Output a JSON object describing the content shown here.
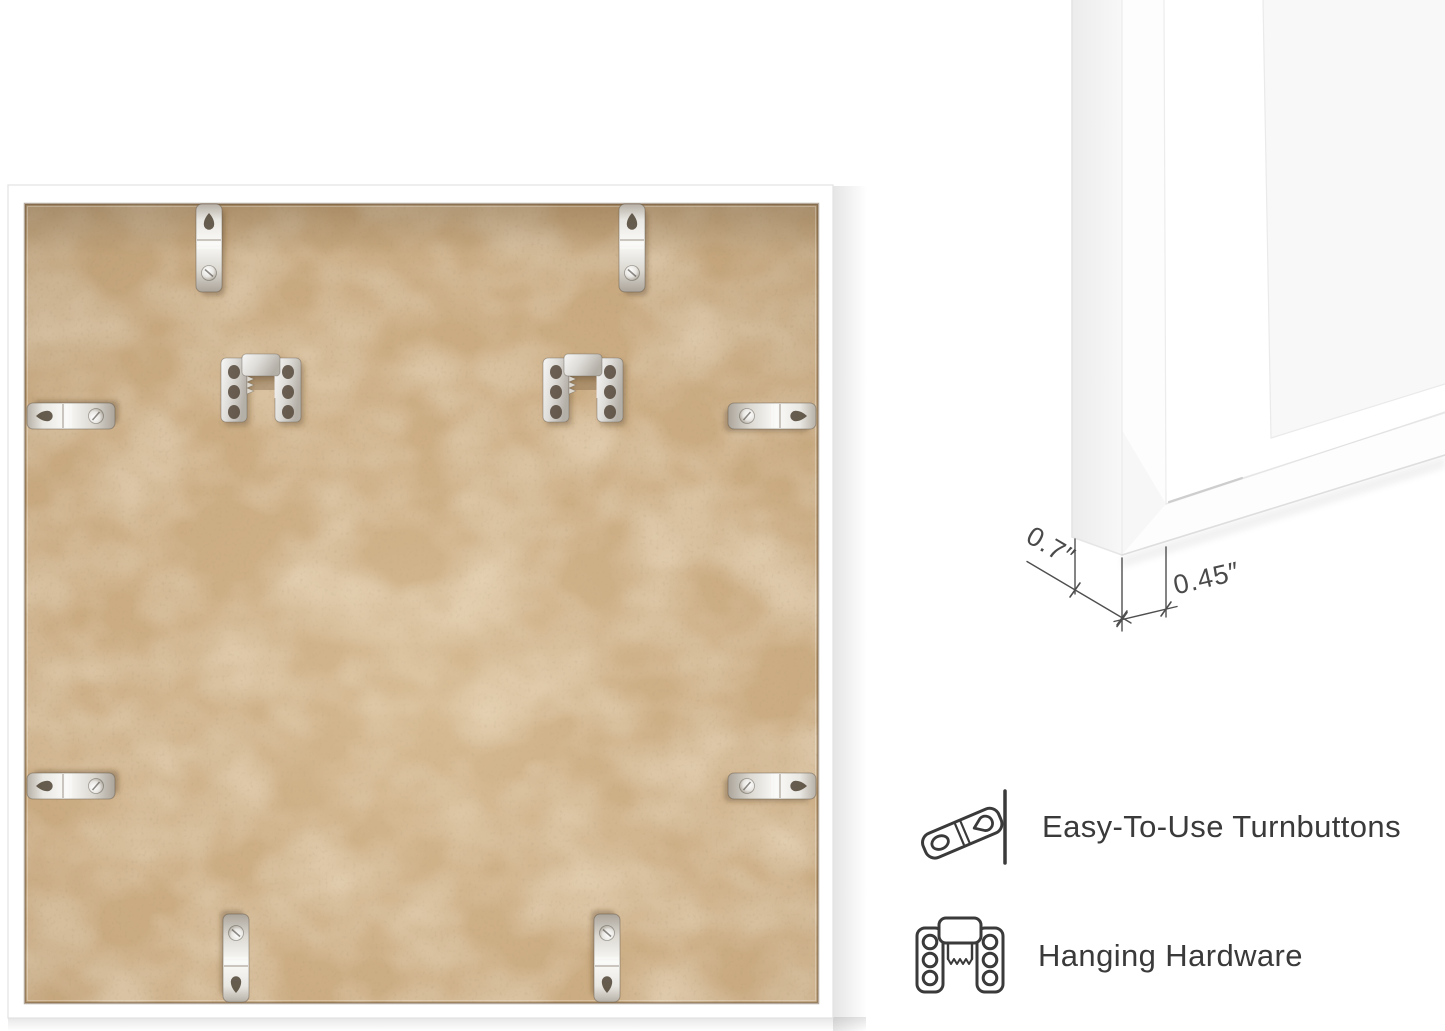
{
  "canvas": {
    "width": 1445,
    "height": 1031,
    "background": "#ffffff"
  },
  "dimension_callout": {
    "depth": "0.7″",
    "face_width": "0.45″"
  },
  "features": [
    {
      "icon": "turnbutton-icon",
      "label": "Easy-To-Use Turnbuttons"
    },
    {
      "icon": "hanging-hardware-icon",
      "label": "Hanging Hardware"
    }
  ],
  "colors": {
    "mdf_base": "#cbac82",
    "mdf_light_fleck": "#e3d1ae",
    "mdf_dark_fleck": "#9c7f58",
    "frame_white": "#ffffff",
    "metal_light": "#f4f3f0",
    "metal_dark": "#b9b3a9",
    "annotation_line": "#4f4f4f",
    "feature_text": "#3a3a3a",
    "icon_stroke": "#3a3a3a",
    "wall_shadow": "#e9e9e9"
  }
}
